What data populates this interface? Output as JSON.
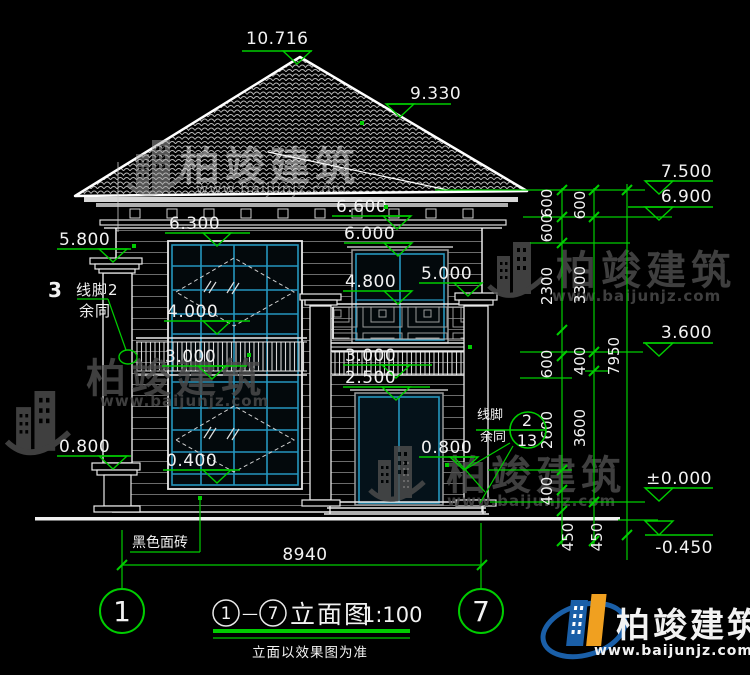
{
  "levels": {
    "peak": "10.716",
    "roof_slope": "9.330",
    "eave_top": "7.500",
    "eave": "6.900",
    "eave_center": "6.600",
    "left_window_top": "6.300",
    "center_window_top": "6.000",
    "left_column_cap": "5.800",
    "right_pilaster_cap": "5.000",
    "center_window_sill": "4.800",
    "left_window_mid": "4.000",
    "second_floor": "3.600",
    "left_railing": "3.000",
    "center_railing": "3.000",
    "balcony_slab": "2.500",
    "left_plinth": "0.800",
    "center_plinth": "0.800",
    "left_window_low": "0.400",
    "ground_floor": "±0.000",
    "site_ground": "-0.450"
  },
  "dims": {
    "overall_width": "8940",
    "chain_inner": [
      "600",
      "600",
      "2300",
      "600",
      "2600",
      "400",
      "450"
    ],
    "chain_middle": [
      "600",
      "3300",
      "400",
      "3600",
      "450"
    ],
    "chain_outer": [
      "7950"
    ]
  },
  "annotations": {
    "axis_note_number": "3",
    "molding_note_line1": "线脚2",
    "molding_note_line2": "余同",
    "molding_right_line1": "线脚",
    "molding_right_line2": "余同",
    "detail_bubble_top": "2",
    "detail_bubble_bottom": "13",
    "material_note": "黑色面砖"
  },
  "axis": {
    "left": "1",
    "right": "7"
  },
  "title_block": {
    "circle_left": "1",
    "circle_right": "7",
    "separator": "—",
    "name": "立面图",
    "scale": "1:100",
    "note": "立面以效果图为准"
  },
  "brand": {
    "name": "柏竣建筑",
    "url": "www.baijunjz.com"
  },
  "colors": {
    "dim_green": "#00cd00",
    "cad_cyan": "#2596be",
    "text_white": "#f2f2f2",
    "brand_blue": "#1a5fa8",
    "brand_orange": "#f0a020"
  }
}
